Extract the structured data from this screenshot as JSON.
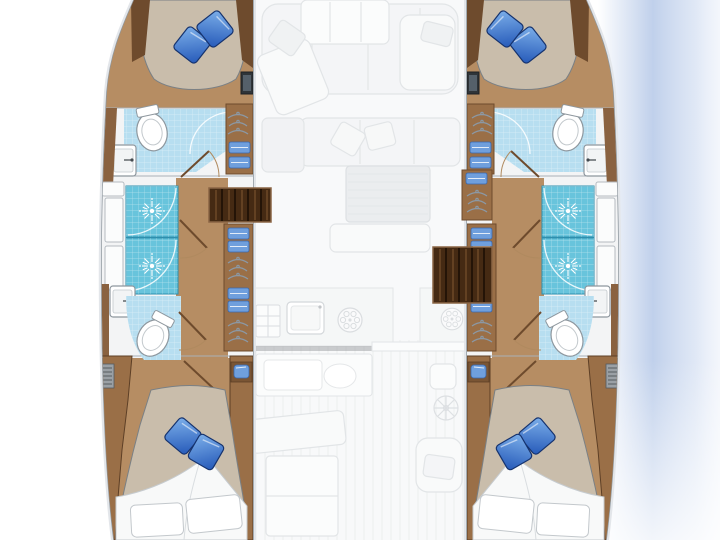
{
  "meta": {
    "title": "Catamaran 4-cabin yacht floor plan",
    "view": "top-down deck plan, bow at top",
    "visible_text": []
  },
  "colors": {
    "background": "#ffffff",
    "hull_fill": "#fcfdfd",
    "hull_outline": "#8e979e",
    "hull_halo": "#e3e6ea",
    "zone_white": "#f3f4f5",
    "wood_floor": "#b68d63",
    "wood_cabinet": "#9a6f47",
    "wood_trim": "#8a6240",
    "wood_trim_dark": "#6e4b2d",
    "steps_dark": "#452a13",
    "steps_slat": "#241407",
    "shower_tile": "#68c4dc",
    "shower_tile_border": "#2e8fae",
    "bath_tile": "#b7def0",
    "mattress": "#c9bdab",
    "mattress_outline": "#7a8085",
    "pillow_blue_light": "#7db0ea",
    "pillow_blue_dark": "#2458b8",
    "pillow_blue_stroke": "#16336e",
    "linen_blue": "#6f9fdd",
    "linen_stroke": "#3b69ad",
    "fixture_white": "#ffffff",
    "fixture_outline": "#8e979e",
    "grille_gray": "#9aa0a5",
    "faded_fill": "#eef0f2",
    "faded_stroke": "#cfd4d8",
    "faded_table": "#dfe2e5",
    "water_wash": "#b9cbe9"
  },
  "port_hull": {
    "label": "port hull",
    "forward_cabin": {
      "berth": "island double berth",
      "pillows_blue": 2,
      "tv_locker": true,
      "wardrobe": {
        "hanger_rack": 1,
        "linen_shelves": 2
      }
    },
    "forward_bathroom": {
      "toilet": true,
      "washbasin": true,
      "tiled_floor": true,
      "shower_door_arc": true
    },
    "midship": {
      "shower_stalls": 2,
      "hull_lockers": 3,
      "washbasin": true,
      "aft_toilet": true,
      "wardrobe": {
        "linen_shelves": 4,
        "hanger_racks": 2
      }
    },
    "companionway": {
      "entry_steps": 4,
      "corridor": true,
      "doors": 4
    },
    "aft_cabin": {
      "berth": "double berth",
      "pillows_blue": 2,
      "pillows_white": 2,
      "duvet": true,
      "side_console": true,
      "vent_grille": true,
      "nightstand_basin": true
    }
  },
  "starboard_hull": {
    "label": "starboard hull",
    "mirrored_layout_of": "port_hull",
    "entry_steps": 4,
    "hanger_rack_above_steps": true
  },
  "salon_faded": {
    "bow_lounge": {
      "table": true,
      "u_sofa": true,
      "chaise_seats": 2,
      "pillows": 3
    },
    "salon": {
      "sofa": true,
      "pillows": 2,
      "ribbed_table": true,
      "bench": true
    },
    "galley": {
      "sink": true,
      "stove_burners": 2,
      "appliance_grid": true,
      "island_counter": true,
      "island_sink": true,
      "dark_counter_edge": true
    },
    "cockpit": {
      "table": true,
      "bench": true,
      "side_seat": true,
      "helm_wheel": true,
      "teak_deck_stripes": true,
      "sliding_door": true
    }
  },
  "effects": {
    "center_opacity": 0.6,
    "starboard_water_wash": true
  }
}
